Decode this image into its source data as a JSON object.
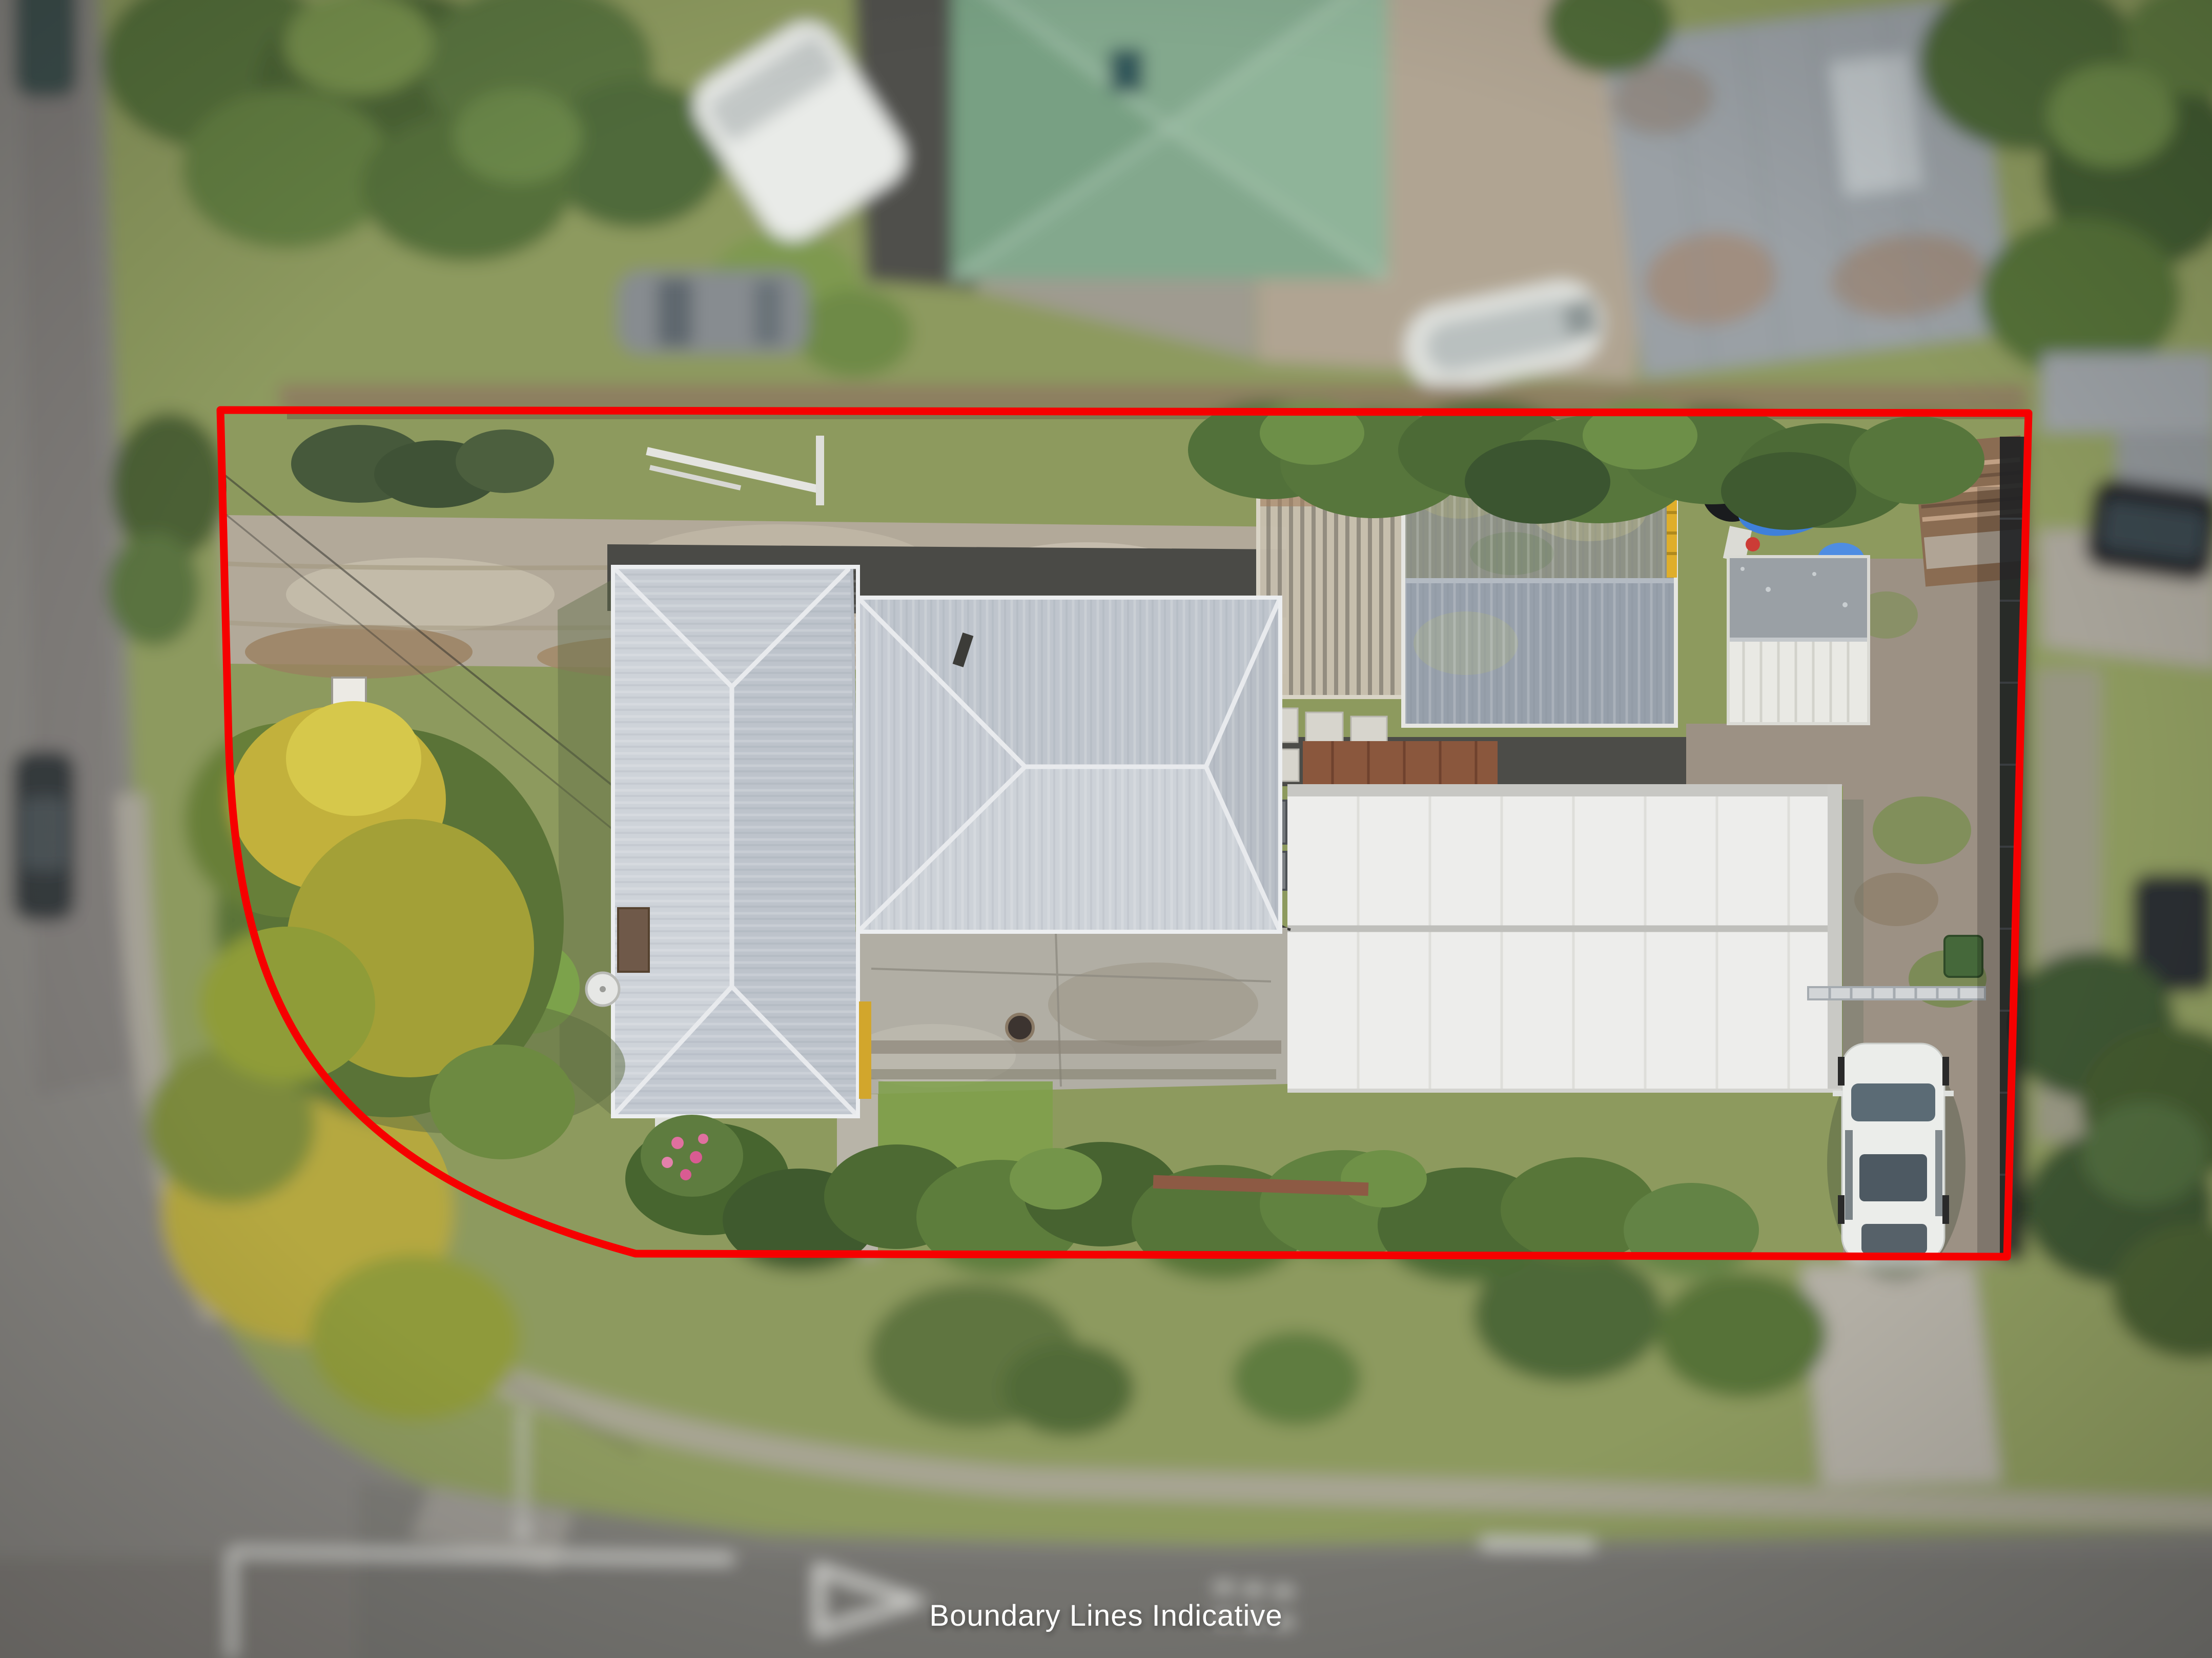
{
  "image": {
    "type": "aerial-drone-photograph",
    "subject": "corner residential property with house, sheds and yard, surrounding streets blurred",
    "caption": "Boundary Lines Indicative"
  },
  "boundary": {
    "color": "#f60000",
    "stroke_width": 15,
    "style": "solid",
    "shape": "rectangle with large rounded bottom-left corner"
  },
  "caption_style": {
    "text_color": "#ffffff",
    "position": "bottom-center"
  },
  "palette": {
    "asphalt_road": "#85837f",
    "asphalt_road_dark": "#7d7b77",
    "grass": "#8d9a5e",
    "driveway_dirt": "#b2a999",
    "concrete": "#b1aea4",
    "house_roof_gray": "#c6cbd2",
    "big_shed_white": "#ededeb",
    "gray_shed_roof": "#97a0ab",
    "carport_clear_roof": "#c9c1b0",
    "rusty_shed": "#8a6c52",
    "tarp_blue": "#3f80da",
    "tree_green_dark": "#4d6837",
    "tree_green": "#5a7340",
    "kowhai_yellow": "#c2b13c",
    "neighbor_green_roof": "#83a88d",
    "white_vehicle": "#ebedea",
    "road_marking_white": "#d9d9d5"
  },
  "features": [
    "main-house-hipped-roof",
    "large-white-shed-roof",
    "gray-gabled-shed",
    "clear-roof-carport",
    "small-white-shed",
    "rusty-shed",
    "blue-tarp",
    "white-van-parked-inside-boundary",
    "front-lawn",
    "kowhai-tree",
    "gravel-driveway",
    "rear-courtyard",
    "black-windbreak-fence",
    "left-street",
    "bottom-street",
    "give-way-triangle-marking",
    "neighbor-green-roof-house",
    "neighbor-gray-shed",
    "boat-on-trailer",
    "parked-cars-on-street"
  ]
}
